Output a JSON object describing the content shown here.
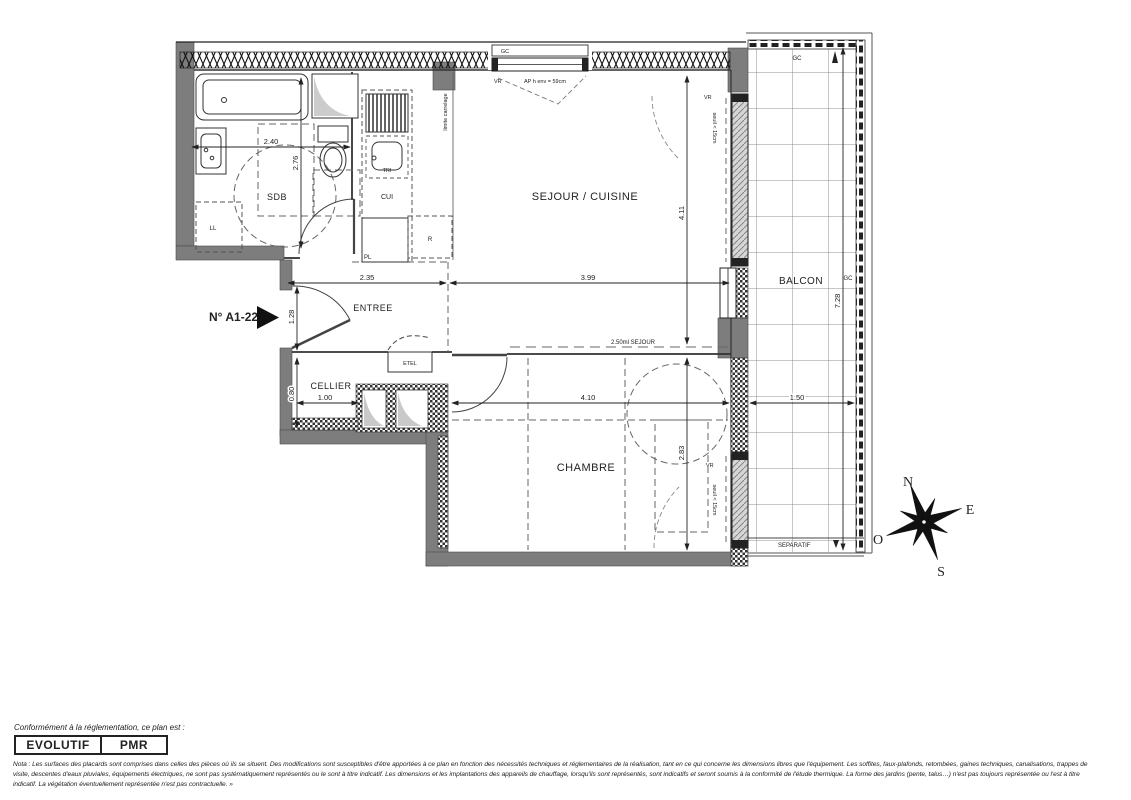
{
  "plan": {
    "unit_number": "N° A1-22",
    "rooms": {
      "sdb": "SDB",
      "entree": "ENTREE",
      "cellier": "CELLIER",
      "sejour": "SEJOUR / CUISINE",
      "chambre": "CHAMBRE",
      "balcon": "BALCON"
    },
    "fixtures": {
      "ll": "LL",
      "cui": "CUI",
      "tri": "TRI",
      "r": "R",
      "pl": "PL",
      "etel": "ETEL"
    },
    "annotations": {
      "gc_window": "GC",
      "gc_balcony_top": "GC",
      "gc_balcony_right": "GC",
      "vr_window": "VR",
      "vr_sejour": "VR",
      "vr_chambre": "VR",
      "ap_height": "AP h env = 59cm",
      "limite_carrelage": "limite carrelage",
      "seuil_sejour": "seuil < 15cm",
      "seuil_chambre": "seuil < 15cm",
      "separatif": "SEPARATIF",
      "sejour_ml": "2.50ml SEJOUR"
    },
    "dimensions": {
      "sdb_w": "2.40",
      "sdb_h": "2.76",
      "entree_w": "2.35",
      "entree_h": "1.28",
      "cellier_w": "1.00",
      "cellier_h": "0.80",
      "sejour_w": "3.99",
      "sejour_h": "4.11",
      "chambre_w": "4.10",
      "chambre_h": "2.83",
      "balcon_h": "7.28",
      "balcon_w": "1.50"
    },
    "compass": {
      "n": "N",
      "e": "E",
      "s": "S",
      "o": "O"
    }
  },
  "footer": {
    "conformity_label": "Conformément à la réglementation, ce plan est :",
    "badges": [
      "EVOLUTIF",
      "PMR"
    ],
    "nota_lines": [
      "Nota : Les surfaces des placards sont comprises dans celles des pièces où ils se situent. Des modifications sont susceptibles d'être apportées à ce plan en fonction des nécessités techniques et réglementaires de la réalisation, tant en ce qui concerne les dimensions libres que l'équipement.  Les soffites, faux-plafonds, retombées, gaines techniques, canalisations, trappes de",
      "visite, descentes d'eaux pluviales, équipements électriques, ne sont pas systématiquement représentés ou le sont à titre indicatif. Les dimensions et les implantations des appareils de chauffage, lorsqu'ils sont représentés, sont indicatifs et seront soumis à la conformité de l'étude thermique.  La forme des jardins (pente, talus…) n'est pas toujours représentée ou l'est à titre",
      "indicatif. La végétation éventuellement représentée n'est pas contractuelle. »"
    ]
  }
}
